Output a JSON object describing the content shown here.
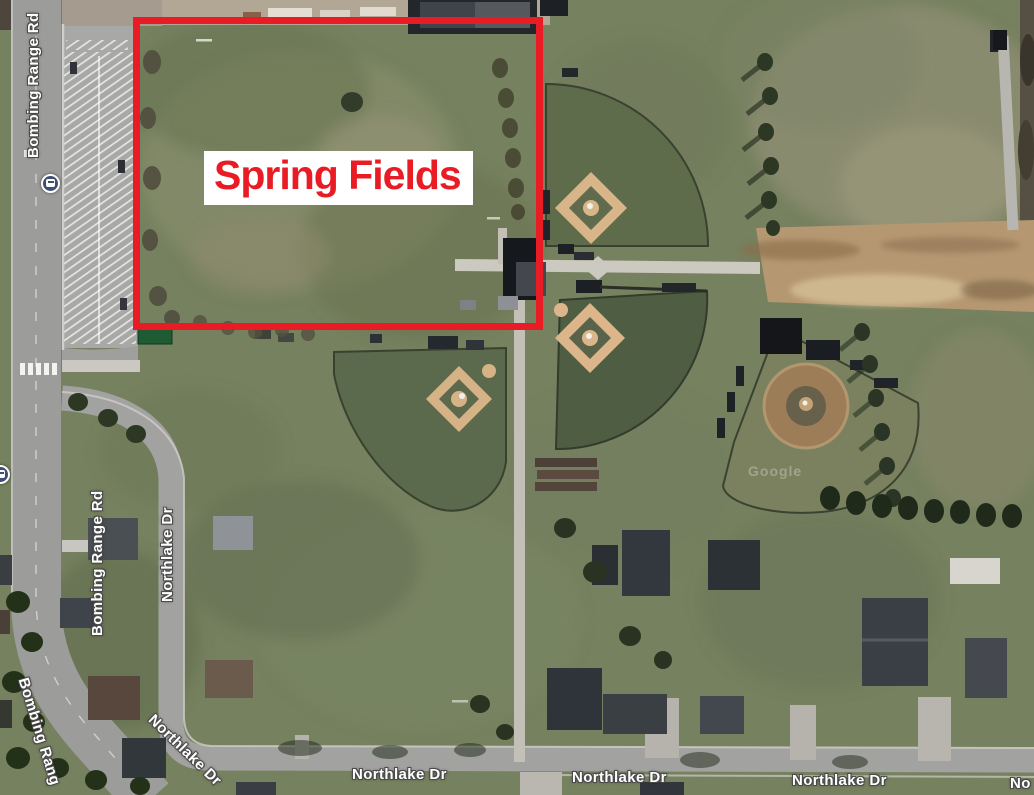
{
  "map": {
    "type": "satellite-aerial",
    "watermark": "Google"
  },
  "annotation": {
    "label": "Spring Fields",
    "highlight_color": "#e91c25",
    "label_background": "#ffffff"
  },
  "road_labels": {
    "bombing_range_rd_upper": "Bombing Range Rd",
    "bombing_range_rd_lower": "Bombing Range Rd",
    "bombing_range_rd_corner": "Bombing Rang",
    "northlake_dr_vertical": "Northlake Dr",
    "northlake_dr_bend": "Northlake Dr",
    "northlake_dr_center_left": "Northlake Dr",
    "northlake_dr_center": "Northlake Dr",
    "northlake_dr_right": "Northlake Dr",
    "northlake_dr_edge_partial": "No"
  },
  "icons": {
    "bus_stop_upper": "bus-stop-icon",
    "bus_stop_lower": "bus-stop-icon"
  }
}
